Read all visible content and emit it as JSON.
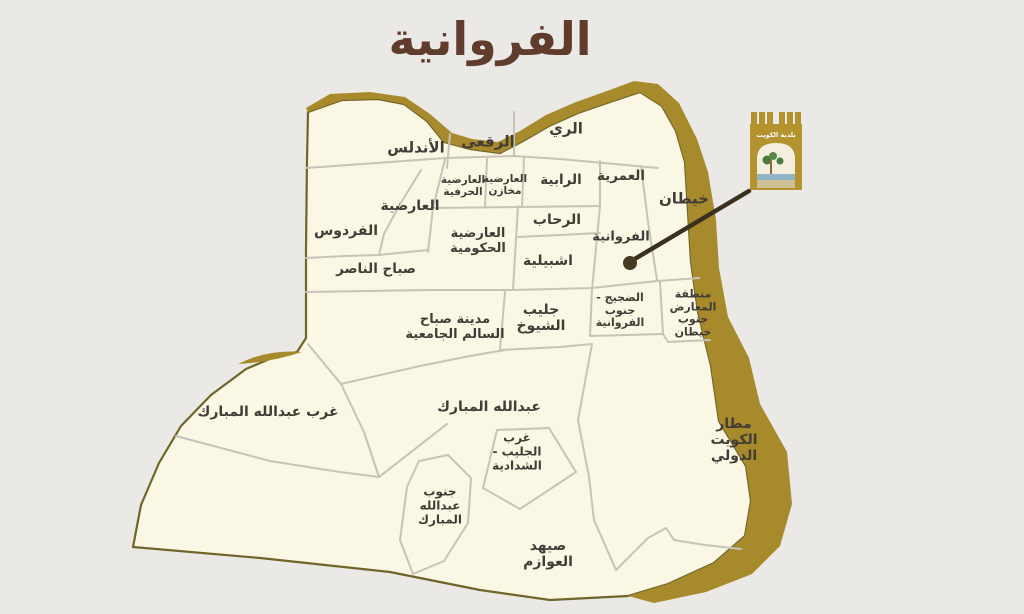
{
  "title": {
    "text": "الفروانية",
    "color": "#5f3c2b"
  },
  "logo": {
    "name": "kuwait-municipality-emblem",
    "text": "بلدية الكويت",
    "gold_color": "#b3922f"
  },
  "page": {
    "background_color": "#ebe9e6"
  },
  "map": {
    "region_fill_color": "#fbf7e5",
    "outer_boundary_color": "#6f652a",
    "gold_band_color": "#a78a2c",
    "district_line_color": "#c8c3b8",
    "label_color": "#413c36",
    "pointer_color": "#39301d",
    "districts": [
      {
        "id": "andalus",
        "label": "الأندلس",
        "x": 416,
        "y": 148,
        "size": 15
      },
      {
        "id": "raqai",
        "label": "الرقعى",
        "x": 488,
        "y": 142,
        "size": 15
      },
      {
        "id": "rai",
        "label": "الري",
        "x": 566,
        "y": 129,
        "size": 15
      },
      {
        "id": "ardiya-herafiya",
        "label": "العارضية\nالحرفية",
        "x": 463,
        "y": 186,
        "size": 10.5
      },
      {
        "id": "ardiya-makhazen",
        "label": "العارضية\nمخازن",
        "x": 505,
        "y": 185,
        "size": 10.5
      },
      {
        "id": "rabiya",
        "label": "الرابية",
        "x": 561,
        "y": 181,
        "size": 13.5
      },
      {
        "id": "omariya",
        "label": "العمرية",
        "x": 621,
        "y": 177,
        "size": 13.5
      },
      {
        "id": "khaitan",
        "label": "خيطان",
        "x": 684,
        "y": 199,
        "size": 15
      },
      {
        "id": "ardiya",
        "label": "العارضية",
        "x": 410,
        "y": 206,
        "size": 14
      },
      {
        "id": "ferdous",
        "label": "الفردوس",
        "x": 346,
        "y": 231,
        "size": 14
      },
      {
        "id": "ardiya-hukumiya",
        "label": "العارضية\nالحكومية",
        "x": 478,
        "y": 242,
        "size": 13
      },
      {
        "id": "rehab",
        "label": "الرحاب",
        "x": 557,
        "y": 220,
        "size": 14
      },
      {
        "id": "ishbiliya",
        "label": "اشبيلية",
        "x": 548,
        "y": 261,
        "size": 14
      },
      {
        "id": "farwaniya",
        "label": "الفروانية",
        "x": 621,
        "y": 238,
        "size": 13
      },
      {
        "id": "sabah-al-nasser",
        "label": "صباح الناصر",
        "x": 376,
        "y": 270,
        "size": 13.5
      },
      {
        "id": "sabah-al-salem-uni",
        "label": "مدينة صباح\nالسالم الجامعية",
        "x": 455,
        "y": 328,
        "size": 13
      },
      {
        "id": "jleeb-al-shuyoukh",
        "label": "جليب\nالشيوخ",
        "x": 541,
        "y": 318,
        "size": 14
      },
      {
        "id": "dajeej",
        "label": "الضجيج -\nجنوب\nالفروانية",
        "x": 620,
        "y": 311,
        "size": 11
      },
      {
        "id": "exhibition-area",
        "label": "منطقة\nالمعارض\nجنوب\nخيطان",
        "x": 693,
        "y": 314,
        "size": 11
      },
      {
        "id": "west-abdullah",
        "label": "غرب عبدالله المبارك",
        "x": 268,
        "y": 412,
        "size": 14
      },
      {
        "id": "abdullah-mubarak",
        "label": "عبدالله المبارك",
        "x": 489,
        "y": 407,
        "size": 14
      },
      {
        "id": "west-jleeb",
        "label": "غرب\nالجليب -\nالشدادية",
        "x": 517,
        "y": 452,
        "size": 12
      },
      {
        "id": "south-abdullah",
        "label": "جنوب\nعبدالله\nالمبارك",
        "x": 440,
        "y": 506,
        "size": 12
      },
      {
        "id": "airport",
        "label": "مطار\nالكويت\nالدولي",
        "x": 734,
        "y": 440,
        "size": 14
      },
      {
        "id": "sihad-al-awazem",
        "label": "صيهد\nالعوازم",
        "x": 548,
        "y": 554,
        "size": 14
      }
    ]
  }
}
